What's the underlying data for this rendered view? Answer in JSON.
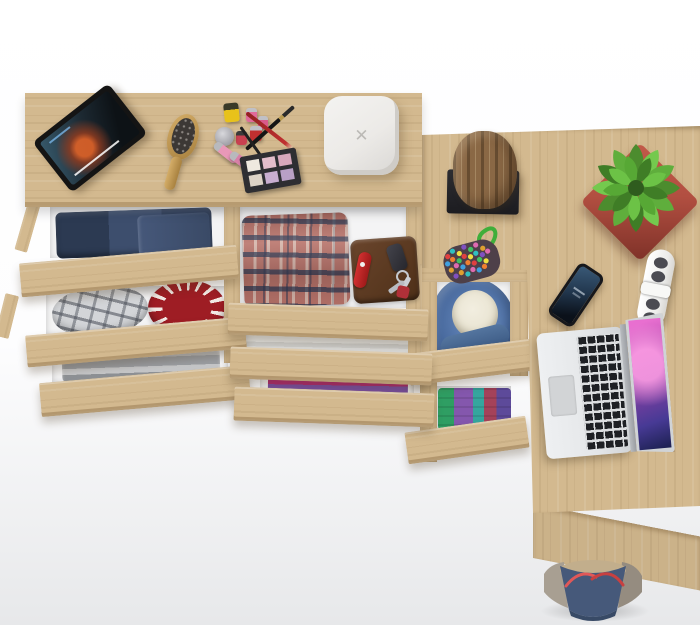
{
  "scene": {
    "description": "Top-down studio render of a light oak (Sonoma) dresser with six pulled-open drawers joined to an L-shaped corner desk with two under-desk drawers; clothes and accessories fill the drawers, gadgets and decor sit on the surfaces, a tote bag rests below the desk.",
    "background": "white studio fading to light gray",
    "visible_text": "none"
  },
  "palette": {
    "wood": "#d3b98f",
    "wood-dark": "#c3a77d",
    "wood-edge": "#ab8f64",
    "interior": "#f4f4f5",
    "bg-bottom": "#e7e8ea",
    "denim": "#35445f",
    "plaid-red": "#b9746b",
    "plaid-navy": "#2a3854",
    "red-accent": "#9e1d24",
    "hoodie-blue": "#47689c",
    "hoodie-lining": "#e9e4d2",
    "pot-red": "#b24f41",
    "plant-green": "#55a036",
    "laptop-silver": "#e4e6e8",
    "screen-magenta": "#c050b0",
    "bag-blue": "#46597a",
    "bag-taupe": "#a89f92",
    "strap-red": "#d84a4a",
    "device-white": "#eceae7",
    "log-brown": "#8a6845"
  },
  "icons": {
    "x_logo": "✕"
  },
  "furniture": {
    "dresser_top_items": [
      "tablet-playing-movie",
      "teal-tablet-stand",
      "wooden-hairbrush",
      "yellow-nail-polish",
      "pink-nail-polishes",
      "red-nail-polish",
      "silver-cosmetic-jar",
      "lip-gloss-tubes",
      "black-makeup-brush",
      "red-makeup-pencil",
      "black-eyeliner-pencil",
      "eyeshadow-palette",
      "white-square-charger"
    ],
    "dresser_drawers": [
      {
        "name": "drawer-jeans",
        "contents": [
          "folded-dark-jeans"
        ]
      },
      {
        "name": "drawer-accessories",
        "contents": [
          "gray-plaid-flat-cap",
          "red-white-patterned-disc"
        ]
      },
      {
        "name": "drawer-gray-clothes",
        "contents": [
          "gray-folded-garment"
        ]
      },
      {
        "name": "drawer-plaid-shirt",
        "contents": [
          "red-blue-plaid-shirt",
          "brown-leather-wallet",
          "red-pocket-knife",
          "car-key-fob",
          "key-ring-with-keys",
          "red-key-tag"
        ]
      },
      {
        "name": "drawer-towels",
        "contents": [
          "white-gray-towels"
        ]
      },
      {
        "name": "drawer-colorful",
        "contents": [
          "teal-magenta-purple-clothes"
        ]
      }
    ],
    "desk_drawers": [
      {
        "name": "drawer-hoodie",
        "contents": [
          "blue-hoodie-cream-lining"
        ]
      },
      {
        "name": "drawer-tshirts",
        "contents": [
          "green-purple-teal-red-tshirts"
        ]
      }
    ],
    "desk_items": [
      "log-decor-on-black-stand",
      "potted-green-plant-red-pot",
      "multicolor-beaded-pouch",
      "smartphone",
      "white-power-strip",
      "open-laptop-purple-screen"
    ],
    "floor_items": [
      "blue-taupe-tote-bag-red-straps"
    ]
  }
}
